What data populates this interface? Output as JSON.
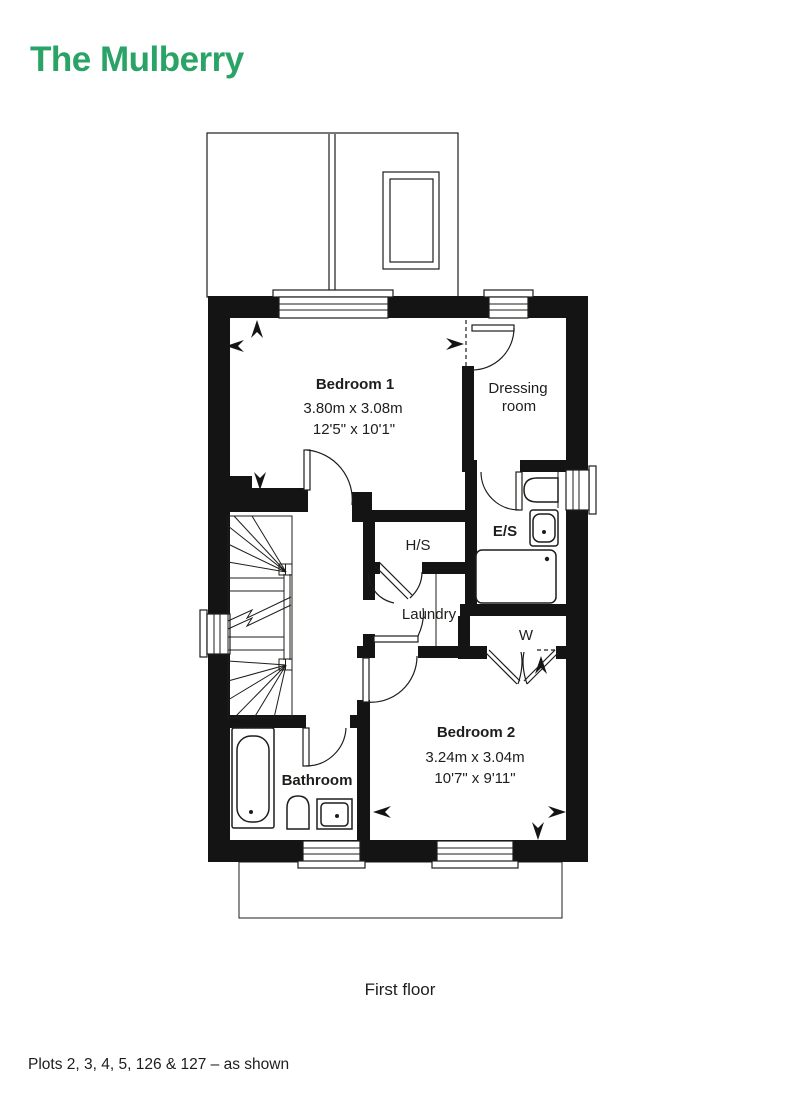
{
  "page": {
    "title": "The Mulberry",
    "caption": "First floor",
    "plots_note": "Plots 2, 3, 4, 5, 126 & 127 – as shown",
    "accent_color": "#2aa366",
    "ink_color": "#1d1d1b"
  },
  "rooms": {
    "bedroom1": {
      "name": "Bedroom 1",
      "size_metric": "3.80m x 3.08m",
      "size_imperial": "12'5\" x 10'1\""
    },
    "dressing_room": {
      "name_line1": "Dressing",
      "name_line2": "room"
    },
    "ensuite": {
      "name": "E/S"
    },
    "hs_cupboard": {
      "name": "H/S"
    },
    "laundry": {
      "name": "Laundry"
    },
    "wardrobe": {
      "name": "W"
    },
    "bedroom2": {
      "name": "Bedroom 2",
      "size_metric": "3.24m x 3.04m",
      "size_imperial": "10'7\" x 9'11\""
    },
    "bathroom": {
      "name": "Bathroom"
    }
  }
}
